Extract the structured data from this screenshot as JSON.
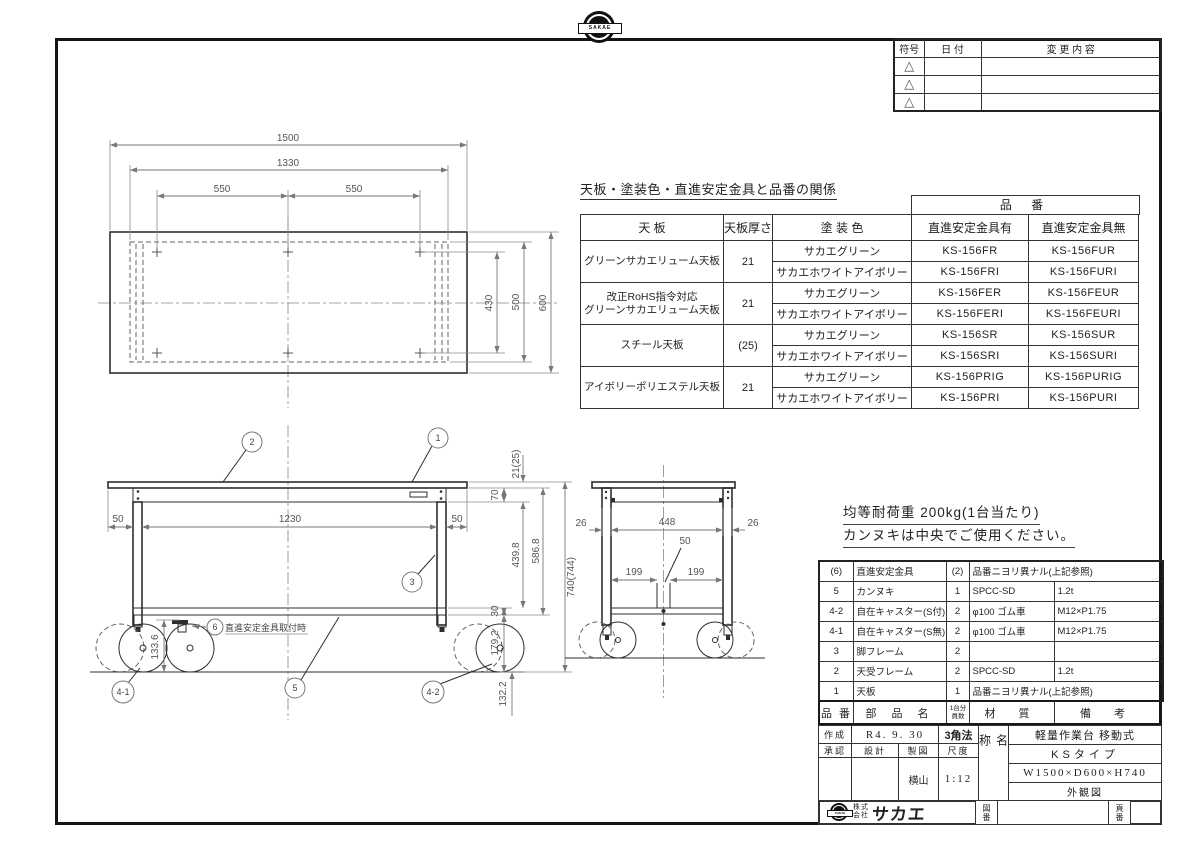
{
  "sheet": {
    "logo_text": "SAKAE",
    "company_name_prefix": "株式会社",
    "company_brand": "サカエ"
  },
  "revision_table": {
    "col_symbol": "符号",
    "col_date": "日 付",
    "col_change": "変 更 内 容",
    "mark": "△"
  },
  "relation_table": {
    "title": "天板・塗装色・直進安定金具と品番の関係",
    "part_no_header": "品 番",
    "col_top": "天 板",
    "col_thickness": "天板厚さ",
    "col_color": "塗 装 色",
    "col_with": "直進安定金具有",
    "col_without": "直進安定金具無",
    "groups": [
      {
        "name1": "グリーンサカエリューム天板",
        "name2": "",
        "thickness": "21",
        "rows": [
          {
            "color": "サカエグリーン",
            "with_no": "KS-156FR",
            "without_no": "KS-156FUR"
          },
          {
            "color": "サカエホワイトアイボリー",
            "with_no": "KS-156FRI",
            "without_no": "KS-156FURI"
          }
        ]
      },
      {
        "name1": "改正RoHS指令対応",
        "name2": "グリーンサカエリューム天板",
        "thickness": "21",
        "rows": [
          {
            "color": "サカエグリーン",
            "with_no": "KS-156FER",
            "without_no": "KS-156FEUR"
          },
          {
            "color": "サカエホワイトアイボリー",
            "with_no": "KS-156FERI",
            "without_no": "KS-156FEURI"
          }
        ]
      },
      {
        "name1": "スチール天板",
        "name2": "",
        "thickness": "(25)",
        "rows": [
          {
            "color": "サカエグリーン",
            "with_no": "KS-156SR",
            "without_no": "KS-156SUR"
          },
          {
            "color": "サカエホワイトアイボリー",
            "with_no": "KS-156SRI",
            "without_no": "KS-156SURI"
          }
        ]
      },
      {
        "name1": "アイボリーポリエステル天板",
        "name2": "",
        "thickness": "21",
        "rows": [
          {
            "color": "サカエグリーン",
            "with_no": "KS-156PRIG",
            "without_no": "KS-156PURIG"
          },
          {
            "color": "サカエホワイトアイボリー",
            "with_no": "KS-156PRI",
            "without_no": "KS-156PURI"
          }
        ]
      }
    ]
  },
  "notes": {
    "line1": "均等耐荷重 200kg(1台当たり)",
    "line2": "カンヌキは中央でご使用ください。"
  },
  "parts_table": {
    "head_no": "品 番",
    "head_name": "部 品 名",
    "head_qty1": "1台分",
    "head_qty2": "員数",
    "head_material": "材 質",
    "head_remarks": "備 考",
    "rows": [
      {
        "no": "(6)",
        "name": "直進安定金具",
        "qty": "(2)",
        "material": "品番ニヨリ異ナル(上記参照)",
        "remarks": ""
      },
      {
        "no": "5",
        "name": "カンヌキ",
        "qty": "1",
        "material": "SPCC-SD",
        "remarks": "1.2t"
      },
      {
        "no": "4-2",
        "name": "自在キャスター(S付)",
        "qty": "2",
        "material": "φ100 ゴム車",
        "remarks": "M12×P1.75"
      },
      {
        "no": "4-1",
        "name": "自在キャスター(S無)",
        "qty": "2",
        "material": "φ100 ゴム車",
        "remarks": "M12×P1.75"
      },
      {
        "no": "3",
        "name": "脚フレーム",
        "qty": "2",
        "material": "",
        "remarks": ""
      },
      {
        "no": "2",
        "name": "天受フレーム",
        "qty": "2",
        "material": "SPCC-SD",
        "remarks": "1.2t"
      },
      {
        "no": "1",
        "name": "天板",
        "qty": "1",
        "material": "品番ニヨリ異ナル(上記参照)",
        "remarks": ""
      }
    ]
  },
  "title_block": {
    "created_label": "作成",
    "created_value": "R4. 9. 30",
    "projection": "3角法",
    "approved_label": "承認",
    "designed_label": "設計",
    "drafted_label": "製図",
    "scale_label": "尺度",
    "drafter": "横山",
    "scale_value": "1:12",
    "name_label": "名称",
    "product_type": "軽量作業台 移動式",
    "product_series": "KSタイプ",
    "product_size": "W1500×D600×H740",
    "drawing_kind": "外観図",
    "drawing_no_label": "図番",
    "page_no_label": "頁番"
  },
  "drawing": {
    "plan": {
      "d_overall": "1500",
      "d_frame": "1330",
      "d_pitch_left": "550",
      "d_pitch_right": "550",
      "d_430": "430",
      "d_500": "500",
      "d_600": "600"
    },
    "front": {
      "d_50_left": "50",
      "d_1230": "1230",
      "d_50_right": "50",
      "d_top_thickness": "21(25)",
      "d_70": "70",
      "d_439_8": "439.8",
      "d_586_8": "586.8",
      "d_30": "30",
      "d_179_2": "179.2",
      "d_height": "740(744)",
      "d_133_6": "133.6",
      "d_132_2": "132.2",
      "balloon_1": "1",
      "balloon_2": "2",
      "balloon_3": "3",
      "balloon_5": "5",
      "balloon_4_1": "4-1",
      "balloon_4_2": "4-2",
      "balloon_6": "6",
      "balloon_6_note": "直進安定金具取付時"
    },
    "side": {
      "d_26_left": "26",
      "d_448": "448",
      "d_26_right": "26",
      "d_50": "50",
      "d_199_left": "199",
      "d_199_right": "199"
    }
  }
}
